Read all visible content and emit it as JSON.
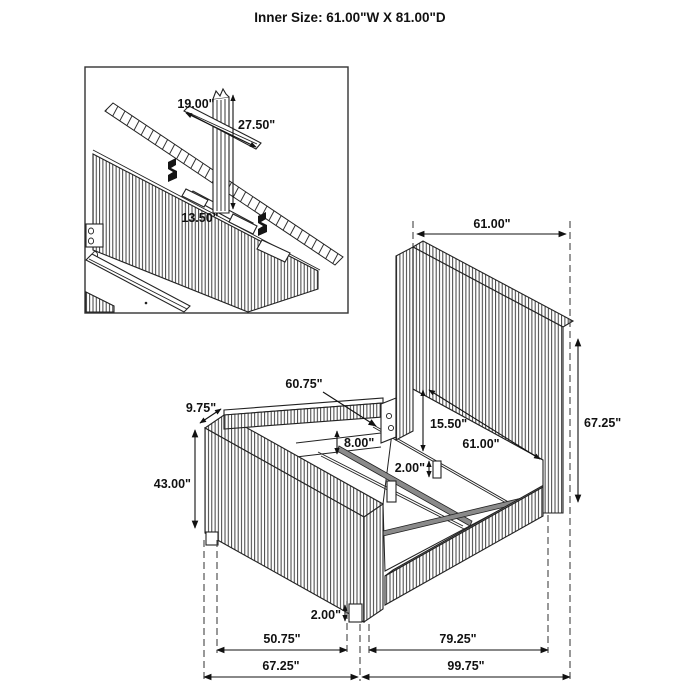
{
  "title": "Inner Size: 61.00\"W X 81.00\"D",
  "inset": {
    "strip_length": "19.00\"",
    "post_height": "27.50\"",
    "bracket_rail_length": "13.50\""
  },
  "main": {
    "top_width": "61.00\"",
    "headboard_height": "67.25\"",
    "slat_length": "60.75\"",
    "footboard_depth": "9.75\"",
    "footboard_height": "43.00\"",
    "platform_clearance": "15.50\"",
    "inner_width": "61.00\"",
    "rail_height": "8.00\"",
    "slat_leg_height": "2.00\"",
    "foot_leg_height": "2.00\"",
    "bottom_row1_left": "50.75\"",
    "bottom_row1_right": "79.25\"",
    "bottom_row2_left": "67.25\"",
    "bottom_row2_right": "99.75\""
  }
}
